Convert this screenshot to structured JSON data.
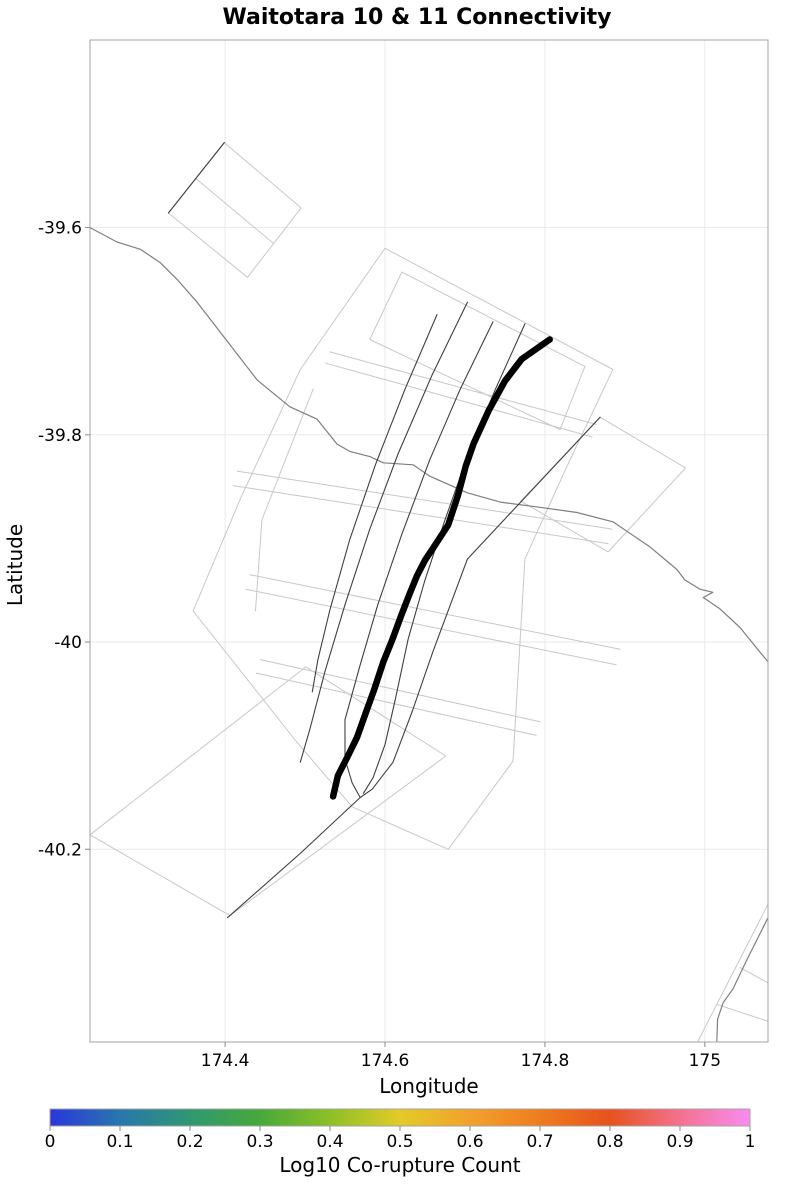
{
  "title": "Waitotara 10 & 11 Connectivity",
  "chart_data": {
    "type": "line",
    "subtype": "geographic-fault-map",
    "title": "Waitotara 10 & 11 Connectivity",
    "xlabel": "Longitude",
    "ylabel": "Latitude",
    "xlim": [
      174.231,
      175.079
    ],
    "ylim": [
      -40.386,
      -39.419
    ],
    "xticks": [
      174.4,
      174.6,
      174.8,
      175
    ],
    "xtick_labels": [
      "174.4",
      "174.6",
      "174.8",
      "175"
    ],
    "yticks": [
      -39.6,
      -39.8,
      -40,
      -40.2
    ],
    "ytick_labels": [
      "-39.6",
      "-39.8",
      "-40",
      "-40.2"
    ],
    "grid": true,
    "grid_color": "#eaeaea",
    "border_color": "#a3a3a3",
    "tick_color": "#8a8a8a",
    "colorbar": {
      "label": "Log10 Co-rupture Count",
      "ticks": [
        0,
        0.1,
        0.2,
        0.3,
        0.4,
        0.5,
        0.6,
        0.7,
        0.8,
        0.9,
        1
      ],
      "tick_labels": [
        "0",
        "0.1",
        "0.2",
        "0.3",
        "0.4",
        "0.5",
        "0.6",
        "0.7",
        "0.8",
        "0.9",
        "1"
      ],
      "stops": [
        {
          "pos": 0.0,
          "color": "#2b36dc"
        },
        {
          "pos": 0.1,
          "color": "#2877ad"
        },
        {
          "pos": 0.2,
          "color": "#2f9872"
        },
        {
          "pos": 0.3,
          "color": "#47a93a"
        },
        {
          "pos": 0.4,
          "color": "#8dbf27"
        },
        {
          "pos": 0.5,
          "color": "#e3cb27"
        },
        {
          "pos": 0.6,
          "color": "#f2a12c"
        },
        {
          "pos": 0.7,
          "color": "#ef7c1e"
        },
        {
          "pos": 0.8,
          "color": "#e7521e"
        },
        {
          "pos": 0.9,
          "color": "#f3718f"
        },
        {
          "pos": 1.0,
          "color": "#fa8bf2"
        }
      ]
    },
    "layers": [
      {
        "name": "fault-outline-polygons",
        "color": "#c8c8c8",
        "width": 1,
        "lines": [
          [
            [
              174.399,
              -39.518
            ],
            [
              174.495,
              -39.581
            ],
            [
              174.428,
              -39.648
            ],
            [
              174.329,
              -39.586
            ],
            [
              174.399,
              -39.518
            ]
          ],
          [
            [
              174.364,
              -39.553
            ],
            [
              174.46,
              -39.615
            ]
          ],
          [
            [
              174.6,
              -39.62
            ],
            [
              174.885,
              -39.737
            ],
            [
              174.826,
              -39.833
            ],
            [
              174.775,
              -39.92
            ],
            [
              174.76,
              -40.115
            ],
            [
              174.679,
              -40.2
            ],
            [
              174.559,
              -40.159
            ],
            [
              174.489,
              -40.096
            ],
            [
              174.36,
              -39.97
            ],
            [
              174.419,
              -39.862
            ],
            [
              174.494,
              -39.737
            ],
            [
              174.6,
              -39.62
            ]
          ],
          [
            [
              174.231,
              -40.186
            ],
            [
              174.406,
              -40.264
            ],
            [
              174.676,
              -40.11
            ],
            [
              174.501,
              -40.024
            ],
            [
              174.231,
              -40.186
            ]
          ],
          [
            [
              174.869,
              -39.783
            ],
            [
              174.976,
              -39.832
            ],
            [
              174.879,
              -39.913
            ],
            [
              174.77,
              -39.864
            ],
            [
              174.869,
              -39.783
            ]
          ],
          [
            [
              174.621,
              -39.643
            ],
            [
              174.85,
              -39.734
            ],
            [
              174.819,
              -39.795
            ],
            [
              174.581,
              -39.708
            ],
            [
              174.621,
              -39.643
            ]
          ],
          [
            [
              174.415,
              -39.835
            ],
            [
              174.884,
              -39.891
            ]
          ],
          [
            [
              174.41,
              -39.849
            ],
            [
              174.879,
              -39.905
            ]
          ],
          [
            [
              174.431,
              -39.935
            ],
            [
              174.894,
              -40.007
            ]
          ],
          [
            [
              174.426,
              -39.949
            ],
            [
              174.889,
              -40.022
            ]
          ],
          [
            [
              174.444,
              -40.017
            ],
            [
              174.794,
              -40.077
            ]
          ],
          [
            [
              174.439,
              -40.03
            ],
            [
              174.789,
              -40.09
            ]
          ],
          [
            [
              174.531,
              -39.72
            ],
            [
              174.864,
              -39.79
            ]
          ],
          [
            [
              174.526,
              -39.731
            ],
            [
              174.859,
              -39.802
            ]
          ],
          [
            [
              174.51,
              -39.756
            ],
            [
              174.446,
              -39.882
            ],
            [
              174.438,
              -39.97
            ]
          ],
          [
            [
              175.079,
              -40.253
            ],
            [
              174.991,
              -40.386
            ]
          ],
          [
            [
              175.044,
              -40.314
            ],
            [
              175.079,
              -40.329
            ]
          ],
          [
            [
              175.016,
              -40.35
            ],
            [
              175.079,
              -40.366
            ]
          ]
        ]
      },
      {
        "name": "coastline",
        "color": "#7f7f7f",
        "width": 1.2,
        "lines": [
          [
            [
              174.231,
              -39.6
            ],
            [
              174.265,
              -39.614
            ],
            [
              174.294,
              -39.621
            ],
            [
              174.319,
              -39.634
            ],
            [
              174.34,
              -39.65
            ],
            [
              174.365,
              -39.672
            ],
            [
              174.406,
              -39.713
            ],
            [
              174.44,
              -39.747
            ],
            [
              174.454,
              -39.756
            ],
            [
              174.481,
              -39.773
            ],
            [
              174.515,
              -39.785
            ],
            [
              174.54,
              -39.809
            ],
            [
              174.556,
              -39.816
            ],
            [
              174.581,
              -39.821
            ],
            [
              174.598,
              -39.827
            ],
            [
              174.635,
              -39.829
            ],
            [
              174.656,
              -39.84
            ],
            [
              174.703,
              -39.856
            ],
            [
              174.744,
              -39.865
            ],
            [
              174.794,
              -39.87
            ],
            [
              174.84,
              -39.875
            ],
            [
              174.885,
              -39.884
            ],
            [
              174.931,
              -39.908
            ],
            [
              174.965,
              -39.93
            ],
            [
              174.975,
              -39.94
            ],
            [
              174.994,
              -39.949
            ],
            [
              175.01,
              -39.952
            ],
            [
              174.998,
              -39.957
            ],
            [
              175.019,
              -39.968
            ],
            [
              175.044,
              -39.986
            ],
            [
              175.066,
              -40.007
            ],
            [
              175.08,
              -40.02
            ]
          ],
          [
            [
              175.079,
              -40.266
            ],
            [
              175.053,
              -40.306
            ],
            [
              175.035,
              -40.335
            ],
            [
              175.023,
              -40.348
            ],
            [
              175.016,
              -40.364
            ],
            [
              175.015,
              -40.386
            ]
          ]
        ]
      },
      {
        "name": "secondary-fault-traces",
        "color": "#3f3f3f",
        "width": 1.1,
        "lines": [
          [
            [
              174.399,
              -39.518
            ],
            [
              174.329,
              -39.586
            ]
          ],
          [
            [
              174.869,
              -39.783
            ],
            [
              174.703,
              -39.92
            ],
            [
              174.66,
              -40.009
            ],
            [
              174.634,
              -40.067
            ],
            [
              174.61,
              -40.116
            ],
            [
              174.584,
              -40.142
            ],
            [
              174.569,
              -40.15
            ],
            [
              174.494,
              -40.204
            ],
            [
              174.403,
              -40.266
            ]
          ],
          [
            [
              174.703,
              -39.672
            ],
            [
              174.659,
              -39.742
            ],
            [
              174.616,
              -39.819
            ],
            [
              174.581,
              -39.891
            ],
            [
              174.55,
              -39.964
            ],
            [
              174.525,
              -40.028
            ],
            [
              174.506,
              -40.084
            ],
            [
              174.494,
              -40.116
            ]
          ],
          [
            [
              174.735,
              -39.691
            ],
            [
              174.694,
              -39.756
            ],
            [
              174.656,
              -39.824
            ],
            [
              174.621,
              -39.896
            ],
            [
              174.591,
              -39.964
            ],
            [
              174.569,
              -40.022
            ],
            [
              174.55,
              -40.075
            ],
            [
              174.55,
              -40.113
            ],
            [
              174.559,
              -40.136
            ],
            [
              174.569,
              -40.15
            ]
          ],
          [
            [
              174.775,
              -39.693
            ],
            [
              174.738,
              -39.756
            ],
            [
              174.704,
              -39.819
            ],
            [
              174.675,
              -39.882
            ],
            [
              174.65,
              -39.94
            ],
            [
              174.629,
              -39.997
            ],
            [
              174.613,
              -40.055
            ],
            [
              174.6,
              -40.099
            ],
            [
              174.585,
              -40.131
            ],
            [
              174.573,
              -40.146
            ]
          ],
          [
            [
              174.665,
              -39.684
            ],
            [
              174.625,
              -39.756
            ],
            [
              174.588,
              -39.829
            ],
            [
              174.556,
              -39.901
            ],
            [
              174.531,
              -39.969
            ],
            [
              174.516,
              -40.017
            ],
            [
              174.509,
              -40.048
            ]
          ]
        ]
      },
      {
        "name": "waitotara-fault-trace",
        "color": "#000000",
        "width": 6.5,
        "lines": [
          [
            [
              174.806,
              -39.708
            ],
            [
              174.771,
              -39.727
            ],
            [
              174.75,
              -39.748
            ],
            [
              174.73,
              -39.776
            ],
            [
              174.711,
              -39.808
            ],
            [
              174.701,
              -39.83
            ],
            [
              174.691,
              -39.859
            ],
            [
              174.679,
              -39.887
            ],
            [
              174.663,
              -39.906
            ],
            [
              174.65,
              -39.921
            ],
            [
              174.64,
              -39.936
            ],
            [
              174.63,
              -39.955
            ],
            [
              174.62,
              -39.975
            ],
            [
              174.609,
              -39.998
            ],
            [
              174.598,
              -40.019
            ],
            [
              174.586,
              -40.047
            ],
            [
              174.578,
              -40.064
            ],
            [
              174.565,
              -40.092
            ],
            [
              174.553,
              -40.111
            ],
            [
              174.541,
              -40.129
            ],
            [
              174.535,
              -40.149
            ]
          ]
        ]
      }
    ]
  }
}
